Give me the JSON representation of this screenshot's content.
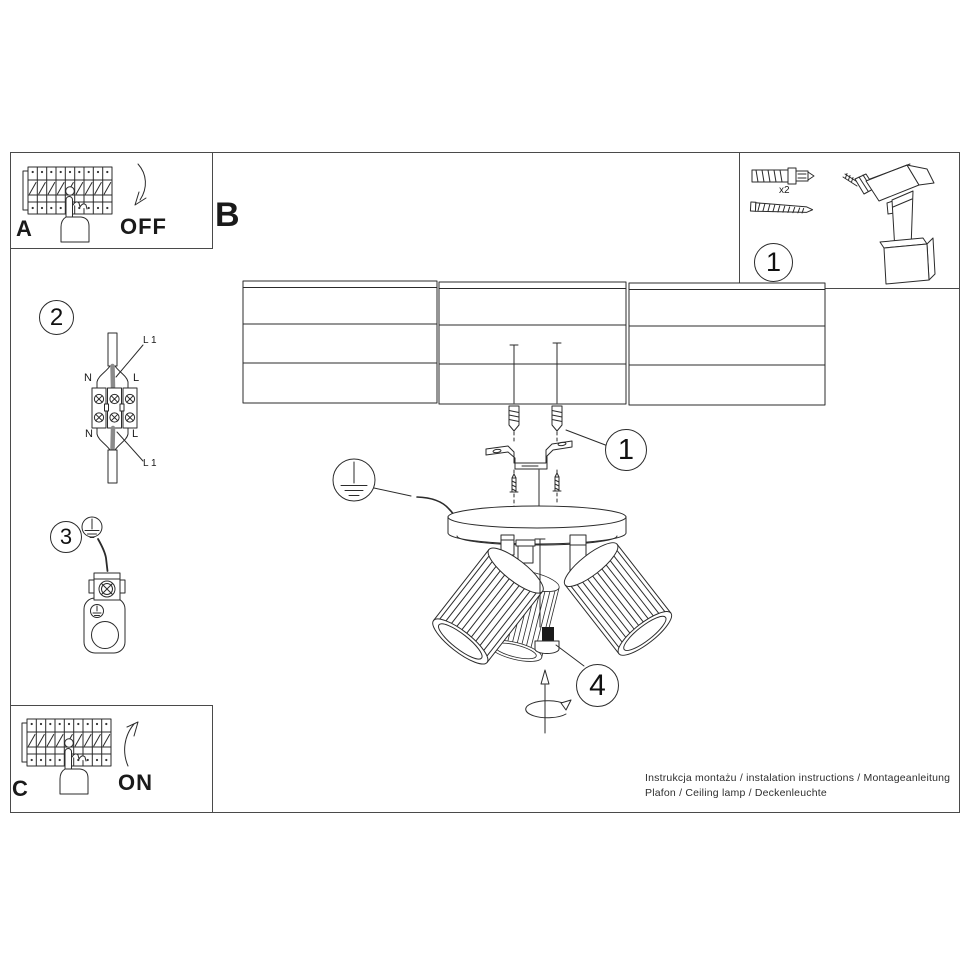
{
  "document": {
    "sections": {
      "power_off": {
        "label": "A",
        "action": "OFF"
      },
      "mounting": {
        "label": "B"
      },
      "power_on": {
        "label": "C",
        "action": "ON"
      }
    },
    "tools": {
      "callout": "1",
      "plug_quantity": "x2"
    },
    "callouts": {
      "bracket_parts": "1",
      "wiring_step": "2",
      "ground_step": "3",
      "adjust_step": "4"
    },
    "wiring_labels": {
      "l1_top": "L 1",
      "n_top": "N",
      "l_top": "L",
      "n_bottom": "N",
      "l_bottom": "L",
      "l1_bottom": "L 1"
    },
    "footer": {
      "line1": "Instrukcja montażu / instalation instructions / Montageanleitung",
      "line2": "Plafon / Ceiling lamp / Deckenleuchte"
    }
  },
  "colors": {
    "line": "#2b2b2b",
    "frame": "#4a4a4a",
    "text": "#1a1a1a",
    "wire_gray": "#8a8a8a"
  }
}
